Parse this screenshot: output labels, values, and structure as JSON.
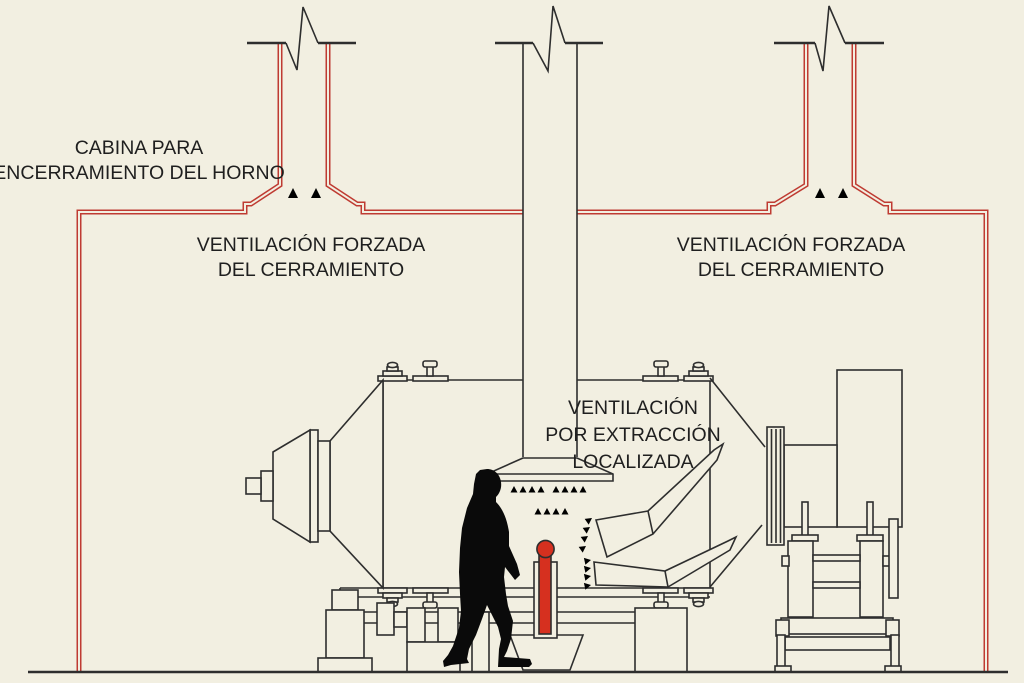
{
  "labels": {
    "cabin": [
      "CABINA PARA",
      "ENCERRAMIENTO DEL HORNO"
    ],
    "forced_left": [
      "VENTILACIÓN FORZADA",
      "DEL CERRAMIENTO"
    ],
    "forced_right": [
      "VENTILACIÓN FORZADA",
      "DEL CERRAMIENTO"
    ],
    "extraction": [
      "VENTILACIÓN",
      "POR EXTRACCIÓN",
      "LOCALIZADA"
    ]
  },
  "colors": {
    "background": "#f2efe1",
    "line": "#2e2e2e",
    "enclosure_red": "#bf3b32",
    "arrow_red": "#c93a2c",
    "ingot_red": "#d6301f",
    "silhouette_black": "#0a0a0a"
  }
}
